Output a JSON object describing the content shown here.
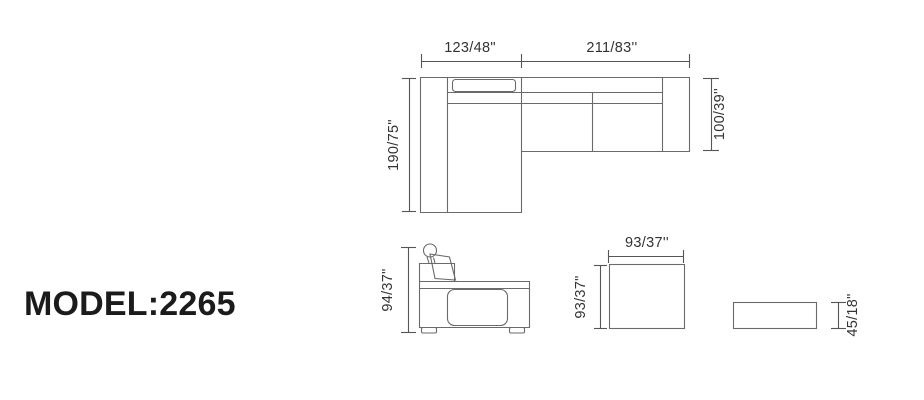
{
  "model_label": "MODEL:2265",
  "plan_view": {
    "dim_top_left": "123/48\"",
    "dim_top_right": "211/83''",
    "dim_left": "190/75\"",
    "dim_right": "100/39''"
  },
  "side_view": {
    "dim_height": "94/37\""
  },
  "ottoman_top_view": {
    "dim_width": "93/37''",
    "dim_depth": "93/37\""
  },
  "ottoman_side_view": {
    "dim_height": "45/18\""
  },
  "colors": {
    "background": "#ffffff",
    "line_color": "#6a6a6a",
    "dim_line_color": "#565656",
    "dimension_text": "#333333",
    "model_text": "#1b1b1b"
  }
}
